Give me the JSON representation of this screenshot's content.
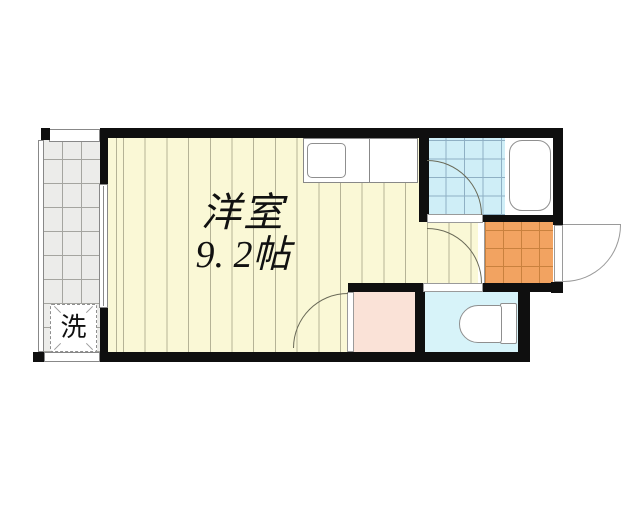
{
  "floorplan": {
    "room": {
      "name": "洋室",
      "size": "9. 2帖"
    },
    "washer_label": "洗",
    "colors": {
      "wall": "#0f0f0f",
      "floor": "#faf8d6",
      "floor_stripe": "#b5b396",
      "balcony": "#ececea",
      "bath_tile": "#cfeef7",
      "genkan_tile": "#f2a361",
      "toilet_floor": "#d7f3f9",
      "closet": "#fae2d7",
      "fixture_outline": "#8f8f8f"
    },
    "fixtures": [
      "bathtub-icon",
      "toilet-icon",
      "kitchen-sink-icon",
      "washing-machine-pad-icon"
    ]
  }
}
